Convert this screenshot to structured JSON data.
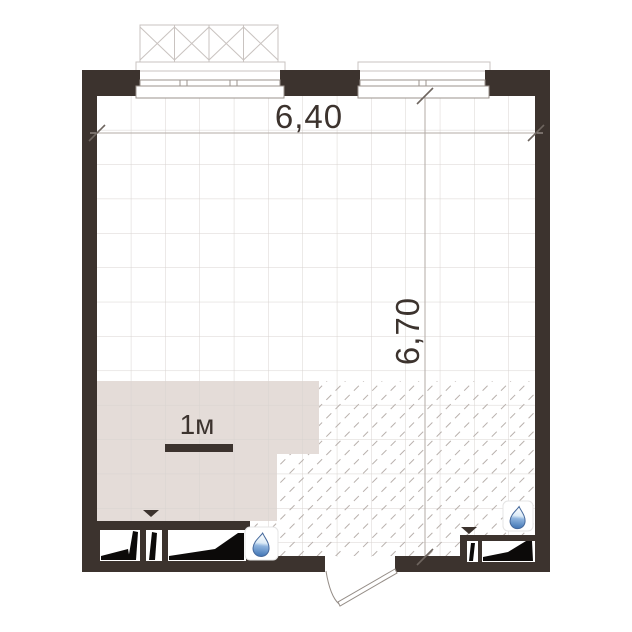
{
  "floor_plan": {
    "dimension_width_label": "6,40",
    "dimension_height_label": "6,70",
    "scale_label": "1м",
    "colors": {
      "wall": "#3c332e",
      "zone_fill": "#e4dcd8",
      "grid_line": "#d8d3d0",
      "hatch_line": "#b8b0ac",
      "dim_line": "#b3aba6",
      "tick": "#6e655f",
      "text": "#3c332e",
      "wedge_black": "#0c0a09",
      "droplet_blue": "#3f74b4",
      "door_line": "#958d87",
      "basket_line": "#c9c3c0"
    },
    "icons": [
      {
        "name": "water-drop-icon"
      },
      {
        "name": "water-drop-icon"
      },
      {
        "name": "triangle-marker-icon"
      },
      {
        "name": "triangle-marker-icon"
      }
    ]
  }
}
